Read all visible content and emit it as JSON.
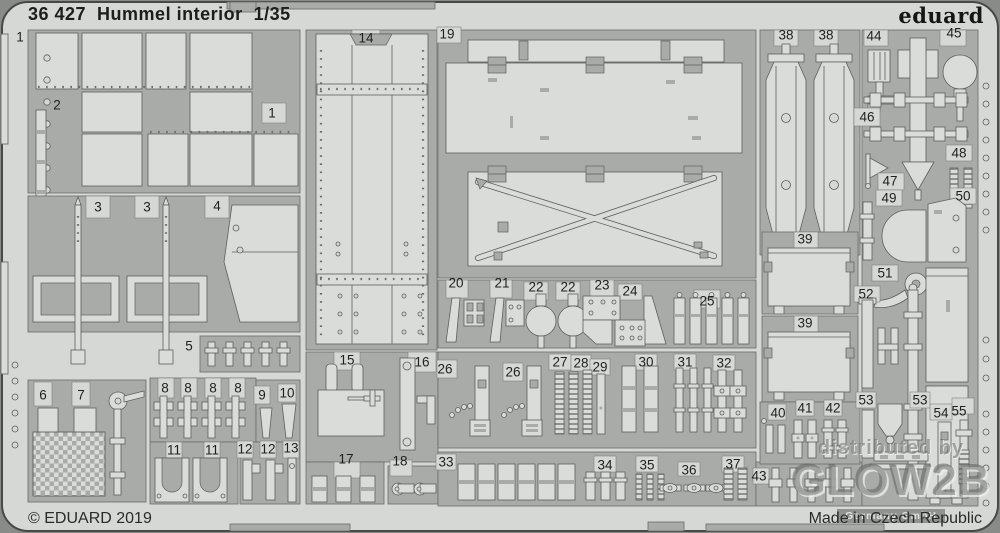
{
  "header": {
    "catalog_number": "36 427",
    "product_name": "Hummel interior",
    "scale": "1/35",
    "title_display": "36 427  Hummel interior  1/35",
    "brand_logo": "eduard"
  },
  "footer": {
    "copyright": "© EDUARD 2019",
    "origin": "Made in Czech Republic"
  },
  "watermark": {
    "line1": "distributed by",
    "line2": "GLOW2B",
    "line3": "Germany GmbH"
  },
  "colors": {
    "photo_background": "#898b89",
    "sheet": "#d6d8d5",
    "sprue_frame": "#a9aba8",
    "part_fill": "#dadcd9",
    "outline": "#5d5f5d",
    "label_text": "#1f1f1f"
  },
  "fret": {
    "parts": [
      {
        "label": "1",
        "x": 20,
        "y": 37
      },
      {
        "label": "1",
        "x": 272,
        "y": 113
      },
      {
        "label": "2",
        "x": 57,
        "y": 105
      },
      {
        "label": "3",
        "x": 98,
        "y": 207
      },
      {
        "label": "3",
        "x": 147,
        "y": 207
      },
      {
        "label": "4",
        "x": 217,
        "y": 206
      },
      {
        "label": "5",
        "x": 189,
        "y": 346
      },
      {
        "label": "6",
        "x": 43,
        "y": 395
      },
      {
        "label": "7",
        "x": 81,
        "y": 395
      },
      {
        "label": "8",
        "x": 165,
        "y": 388
      },
      {
        "label": "8",
        "x": 188,
        "y": 388
      },
      {
        "label": "8",
        "x": 213,
        "y": 388
      },
      {
        "label": "8",
        "x": 238,
        "y": 388
      },
      {
        "label": "9",
        "x": 262,
        "y": 395
      },
      {
        "label": "10",
        "x": 287,
        "y": 393
      },
      {
        "label": "11",
        "x": 174,
        "y": 450
      },
      {
        "label": "11",
        "x": 212,
        "y": 450
      },
      {
        "label": "12",
        "x": 245,
        "y": 449
      },
      {
        "label": "12",
        "x": 268,
        "y": 449
      },
      {
        "label": "13",
        "x": 291,
        "y": 448
      },
      {
        "label": "14",
        "x": 366,
        "y": 38
      },
      {
        "label": "15",
        "x": 347,
        "y": 360
      },
      {
        "label": "16",
        "x": 422,
        "y": 362
      },
      {
        "label": "17",
        "x": 346,
        "y": 459
      },
      {
        "label": "18",
        "x": 400,
        "y": 461
      },
      {
        "label": "19",
        "x": 447,
        "y": 34
      },
      {
        "label": "20",
        "x": 456,
        "y": 283
      },
      {
        "label": "21",
        "x": 502,
        "y": 283
      },
      {
        "label": "22",
        "x": 536,
        "y": 287
      },
      {
        "label": "22",
        "x": 568,
        "y": 287
      },
      {
        "label": "23",
        "x": 602,
        "y": 285
      },
      {
        "label": "24",
        "x": 630,
        "y": 291
      },
      {
        "label": "25",
        "x": 707,
        "y": 301
      },
      {
        "label": "26",
        "x": 445,
        "y": 369
      },
      {
        "label": "26",
        "x": 513,
        "y": 372
      },
      {
        "label": "27",
        "x": 560,
        "y": 362
      },
      {
        "label": "28",
        "x": 581,
        "y": 363
      },
      {
        "label": "29",
        "x": 600,
        "y": 367
      },
      {
        "label": "30",
        "x": 646,
        "y": 362
      },
      {
        "label": "31",
        "x": 685,
        "y": 362
      },
      {
        "label": "32",
        "x": 724,
        "y": 363
      },
      {
        "label": "33",
        "x": 446,
        "y": 462
      },
      {
        "label": "34",
        "x": 605,
        "y": 465
      },
      {
        "label": "35",
        "x": 647,
        "y": 465
      },
      {
        "label": "36",
        "x": 689,
        "y": 470
      },
      {
        "label": "37",
        "x": 733,
        "y": 464
      },
      {
        "label": "38",
        "x": 786,
        "y": 35
      },
      {
        "label": "38",
        "x": 826,
        "y": 35
      },
      {
        "label": "39",
        "x": 805,
        "y": 239
      },
      {
        "label": "39",
        "x": 805,
        "y": 323
      },
      {
        "label": "40",
        "x": 778,
        "y": 413
      },
      {
        "label": "41",
        "x": 805,
        "y": 408
      },
      {
        "label": "42",
        "x": 833,
        "y": 408
      },
      {
        "label": "43",
        "x": 759,
        "y": 476
      },
      {
        "label": "44",
        "x": 874,
        "y": 36
      },
      {
        "label": "45",
        "x": 954,
        "y": 33
      },
      {
        "label": "46",
        "x": 867,
        "y": 117
      },
      {
        "label": "47",
        "x": 890,
        "y": 181
      },
      {
        "label": "48",
        "x": 959,
        "y": 153
      },
      {
        "label": "49",
        "x": 889,
        "y": 198
      },
      {
        "label": "50",
        "x": 963,
        "y": 196
      },
      {
        "label": "51",
        "x": 885,
        "y": 273
      },
      {
        "label": "52",
        "x": 866,
        "y": 294
      },
      {
        "label": "53",
        "x": 866,
        "y": 400
      },
      {
        "label": "53",
        "x": 920,
        "y": 400
      },
      {
        "label": "54",
        "x": 941,
        "y": 413
      },
      {
        "label": "55",
        "x": 959,
        "y": 411
      }
    ]
  }
}
